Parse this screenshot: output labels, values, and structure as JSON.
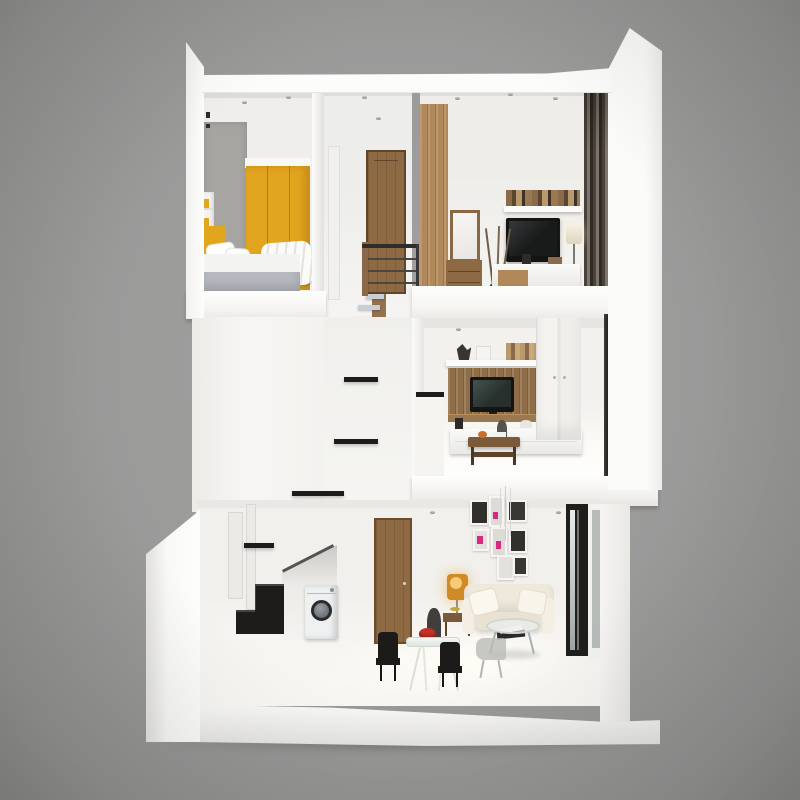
{
  "meta": {
    "description": "3D cutaway dollhouse rendering of a three-story townhouse interior on a plain gray backdrop",
    "background_color": "#9a9a9a"
  },
  "palette": {
    "background_gray": "#9a9a9a",
    "wall_white": "#f5f4f2",
    "wardrobe_yellow": "#e2a51e",
    "accent_wall_gray": "#a6a5a1",
    "bed_front_gray": "#b6b9bf",
    "stair_tread_gray": "#c9ced6",
    "stair_nosing_black": "#1d1c1a",
    "wood_door": "#8d6a44",
    "wood_wardrobe": "#b0885a",
    "wood_dark": "#7a5a38",
    "tv_black": "#141414",
    "curtain_dark": "#463f38",
    "dark_panel": "#241f1b",
    "lamp_amber": "#d08a28",
    "red_bowl": "#c5302a",
    "pink_accent": "#d62a7e",
    "chair_black": "#1c1b19",
    "sofa_cream": "#efe9dc",
    "washer_white": "#eef0f1"
  },
  "scene": {
    "type": "3d-cutaway-dollhouse",
    "floors": [
      {
        "name": "top-floor",
        "rooms": [
          {
            "name": "bedroom",
            "furniture": [
              "gray-accent-wall",
              "yellow-wardrobe",
              "wall-shelves",
              "double-bed",
              "pillows",
              "duvet"
            ]
          },
          {
            "name": "stair-hall",
            "furniture": [
              "wood-door",
              "metal-railing",
              "stair-flight"
            ]
          },
          {
            "name": "media-bedroom",
            "furniture": [
              "wood-wardrobe",
              "dresser-with-mirror",
              "dry-branches",
              "wall-tv",
              "book-shelf",
              "floor-lamp",
              "dark-curtain",
              "sideboard"
            ]
          }
        ]
      },
      {
        "name": "middle-floor",
        "rooms": [
          {
            "name": "stairwell",
            "furniture": [
              "zigzag-staircase",
              "half-landing"
            ]
          },
          {
            "name": "tv-lounge",
            "furniture": [
              "tv-wall-unit",
              "flat-tv",
              "floating-shelf",
              "tall-white-cabinets",
              "low-cabinet",
              "wood-coffee-table",
              "dark-side-panel"
            ]
          }
        ]
      },
      {
        "name": "ground-floor",
        "rooms": [
          {
            "name": "living-dining",
            "furniture": [
              "under-stair-washing-machine",
              "black-stair-steps",
              "wood-door",
              "gallery-picture-wall",
              "pendant-light",
              "amber-floor-lamp",
              "wood-side-table",
              "cream-sofa",
              "round-glass-coffee-table",
              "glass-dining-table",
              "black-chairs",
              "gray-chair",
              "red-bowl",
              "figurine",
              "dark-entry-door"
            ]
          }
        ]
      }
    ]
  }
}
